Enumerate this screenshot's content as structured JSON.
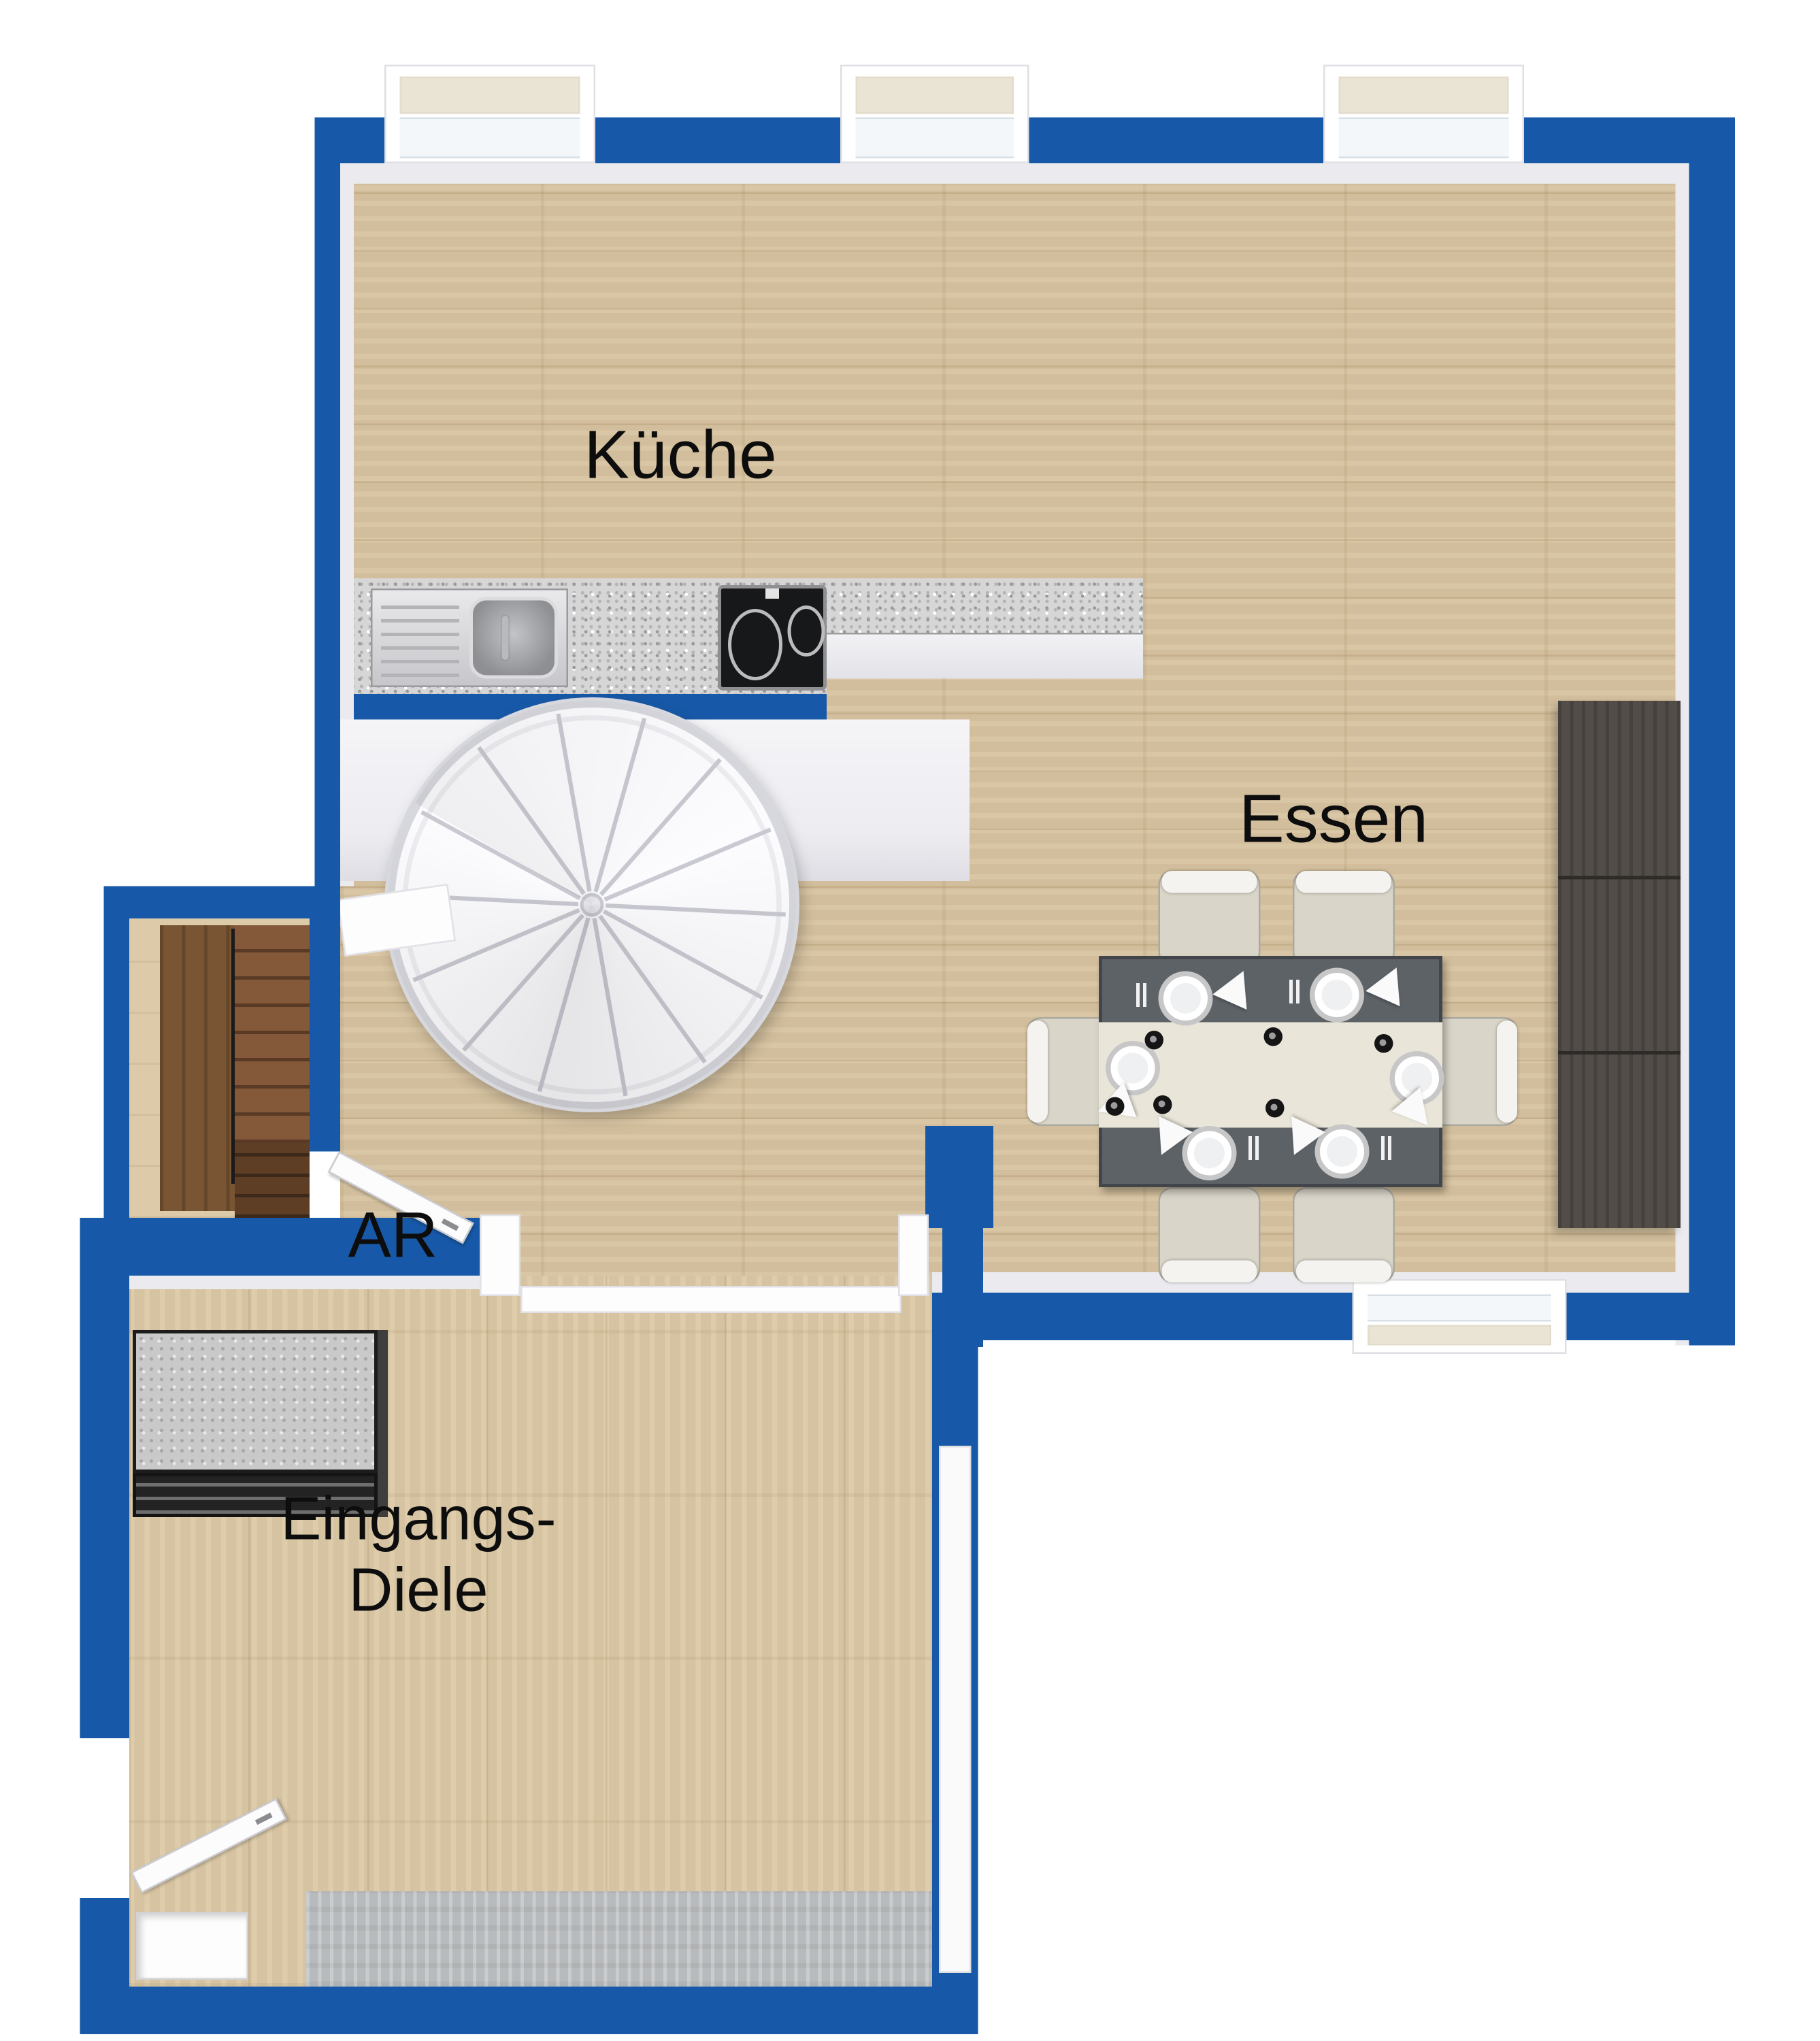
{
  "plan": {
    "type": "3d-floor-plan-top-view",
    "rooms": {
      "kitchen": "Küche",
      "dining": "Essen",
      "storage": "AR",
      "hall_line1": "Eingangs-",
      "hall_line2": "Diele"
    },
    "palette": {
      "wall_blue": "#1759a8",
      "wood_main": "#d7c3a0",
      "wood_hall": "#dcc9a6",
      "granite_counter": "#d6d6d6",
      "sideboard_dark": "#524d49",
      "table_gray": "#5d6267",
      "chair_cream": "#d9d5c9",
      "cellar_stairs_wood": "#7a5534",
      "entry_mat_gray": "#b8bbbd"
    }
  }
}
